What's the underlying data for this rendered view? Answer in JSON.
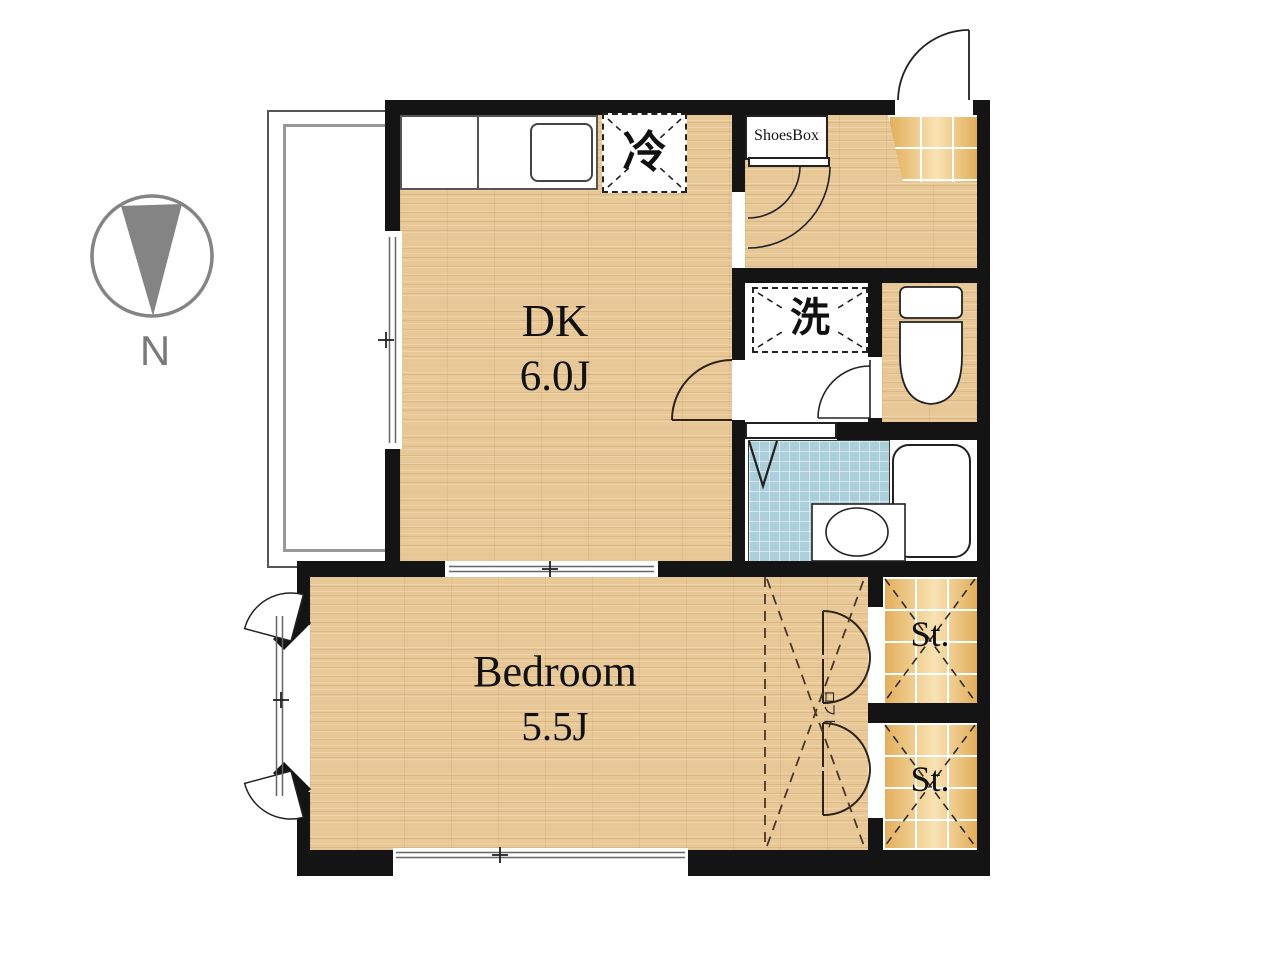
{
  "compass": {
    "label": "N"
  },
  "rooms": {
    "dk": {
      "name": "DK",
      "size": "6.0J"
    },
    "bedroom": {
      "name": "Bedroom",
      "size": "5.5J"
    },
    "storage_top": {
      "label": "St."
    },
    "storage_bottom": {
      "label": "St."
    },
    "loft": {
      "label": "ロフト"
    }
  },
  "fixtures": {
    "refrigerator": {
      "label": "冷"
    },
    "washer": {
      "label": "洗"
    },
    "shoesbox": {
      "label": "ShoesBox"
    }
  },
  "colors": {
    "wall": "#141414",
    "wood_floor": "#e9c897",
    "tile_floor": "#ecbf74",
    "bath_tile": "#accfdc",
    "compass_gray": "#848484",
    "line": "#222222"
  }
}
